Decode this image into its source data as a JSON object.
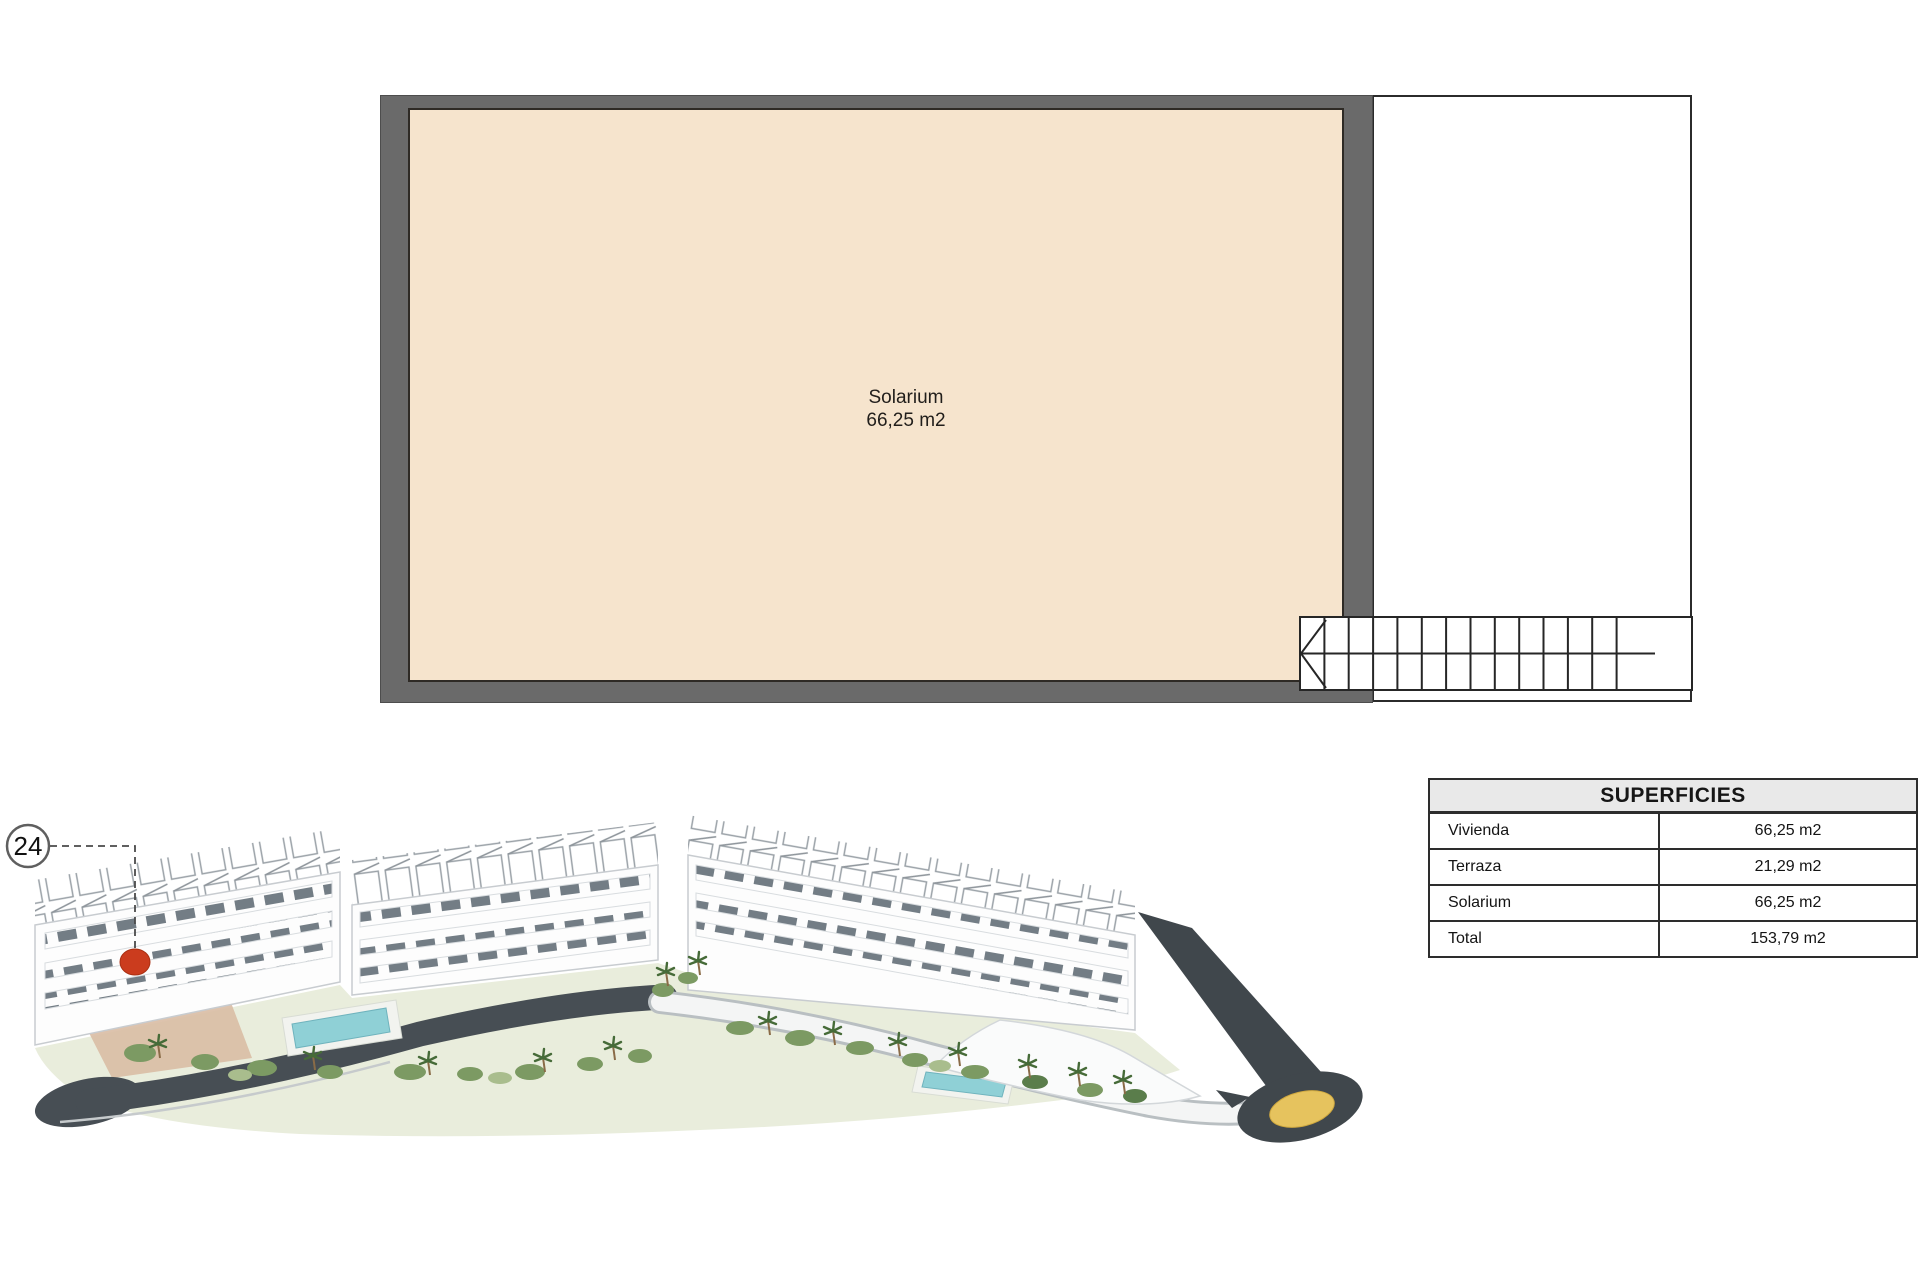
{
  "page": {
    "background": "#ffffff"
  },
  "floor_plan": {
    "room_label": "Solarium",
    "room_area": "66,25 m2",
    "wall_color": "#6a6a6a",
    "room_fill": "#f6e4cd",
    "line_color": "#2b2b2b",
    "stairs": {
      "tread_count": 13
    }
  },
  "unit_callout": {
    "number": "24",
    "marker_color": "#cb3c1e"
  },
  "surfaces_table": {
    "title": "SUPERFICIES",
    "header_bg": "#e9e9e9",
    "border_color": "#2d2d2d",
    "rows": [
      {
        "label": "Vivienda",
        "value": "66,25 m2"
      },
      {
        "label": "Terraza",
        "value": "21,29 m2"
      },
      {
        "label": "Solarium",
        "value": "66,25 m2"
      },
      {
        "label": "Total",
        "value": "153,79 m2"
      }
    ]
  },
  "site_render": {
    "subject": "aerial-render-apartment-complex",
    "building_color": "#fdfdfd",
    "pool_color": "#8fd0d6",
    "greenery_color": "#7c9a63",
    "road_color": "#474e54",
    "roundabout_center_color": "#e6c35e"
  }
}
